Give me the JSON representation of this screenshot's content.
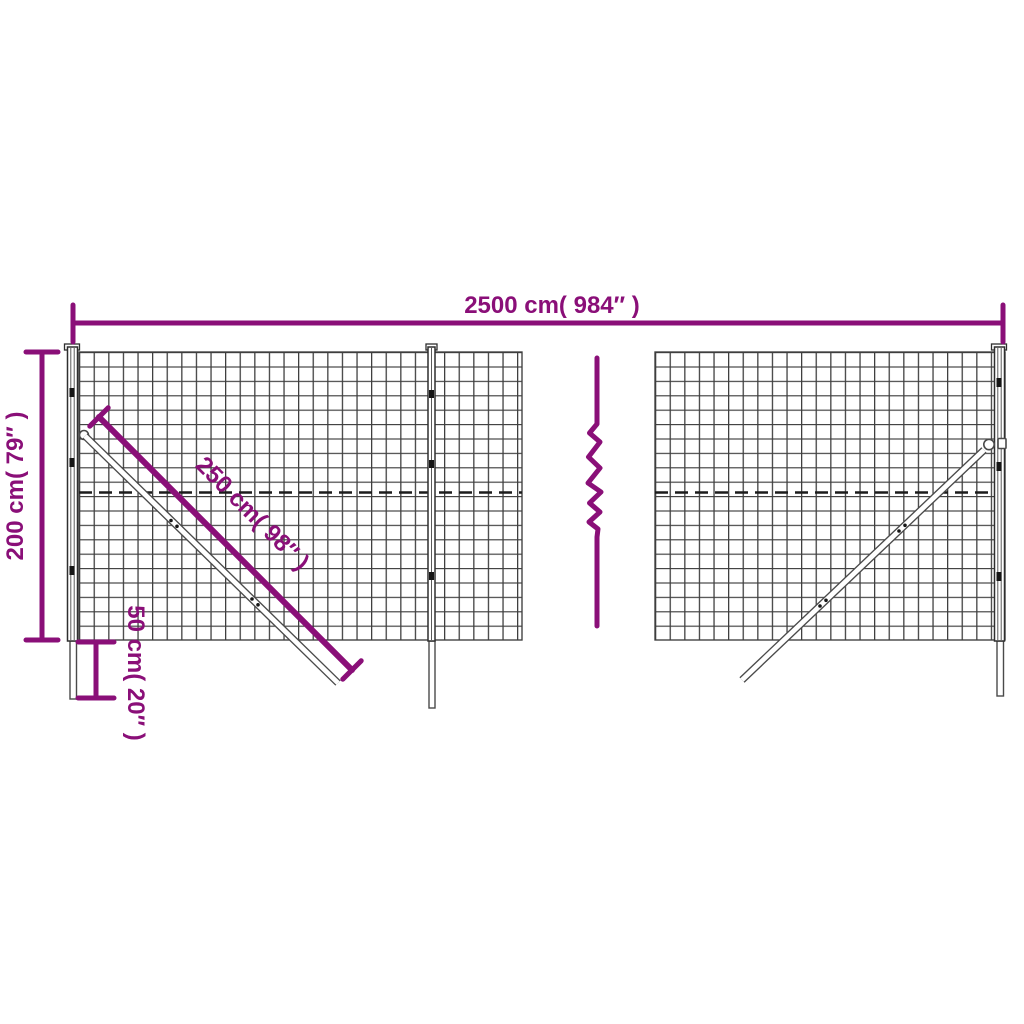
{
  "diagram": {
    "kind": "wire-mesh-fence-dimension-diagram",
    "labels": {
      "total_width": "2500 cm( 984″ )",
      "height": "200 cm( 79″ )",
      "strut_length": "250 cm( 98″ )",
      "ground_depth": "50 cm( 20″ )"
    },
    "colors": {
      "accent": "#8a0f78",
      "mesh": "#3e3e3e",
      "post": "#2f2f2f",
      "dash": "#1c1c1c",
      "strut": "#4a4a4a",
      "background": "#ffffff"
    }
  }
}
